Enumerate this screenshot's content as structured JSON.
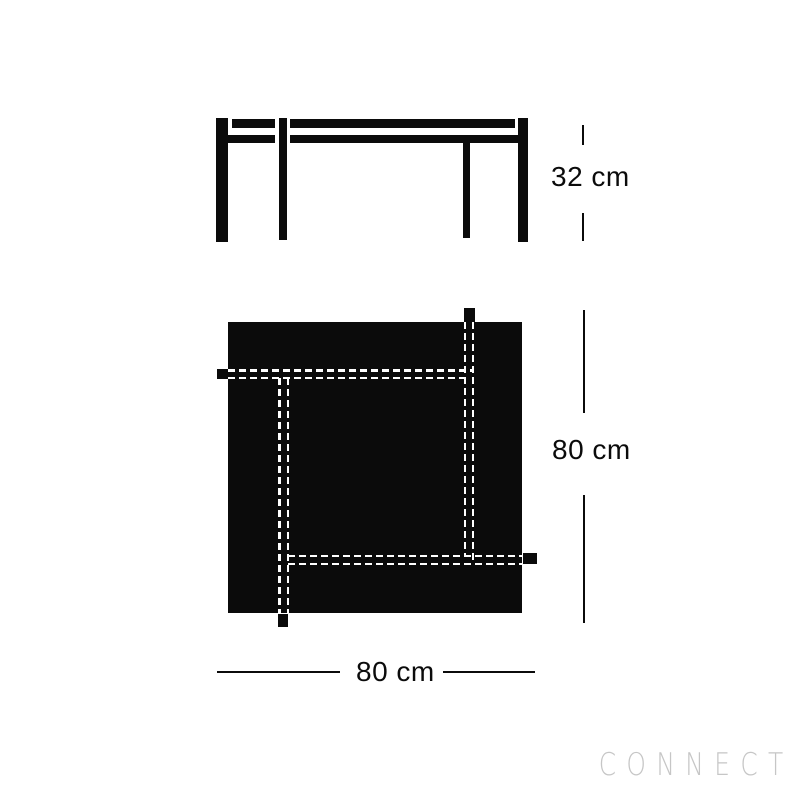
{
  "watermark": "CONNECT",
  "dimensions": {
    "side_height": "32 cm",
    "plan_depth": "80 cm",
    "plan_width": "80 cm"
  },
  "colors": {
    "ink": "#0b0b0b",
    "background": "#ffffff",
    "dash": "#ffffff",
    "watermark": "#c6c6c6"
  }
}
